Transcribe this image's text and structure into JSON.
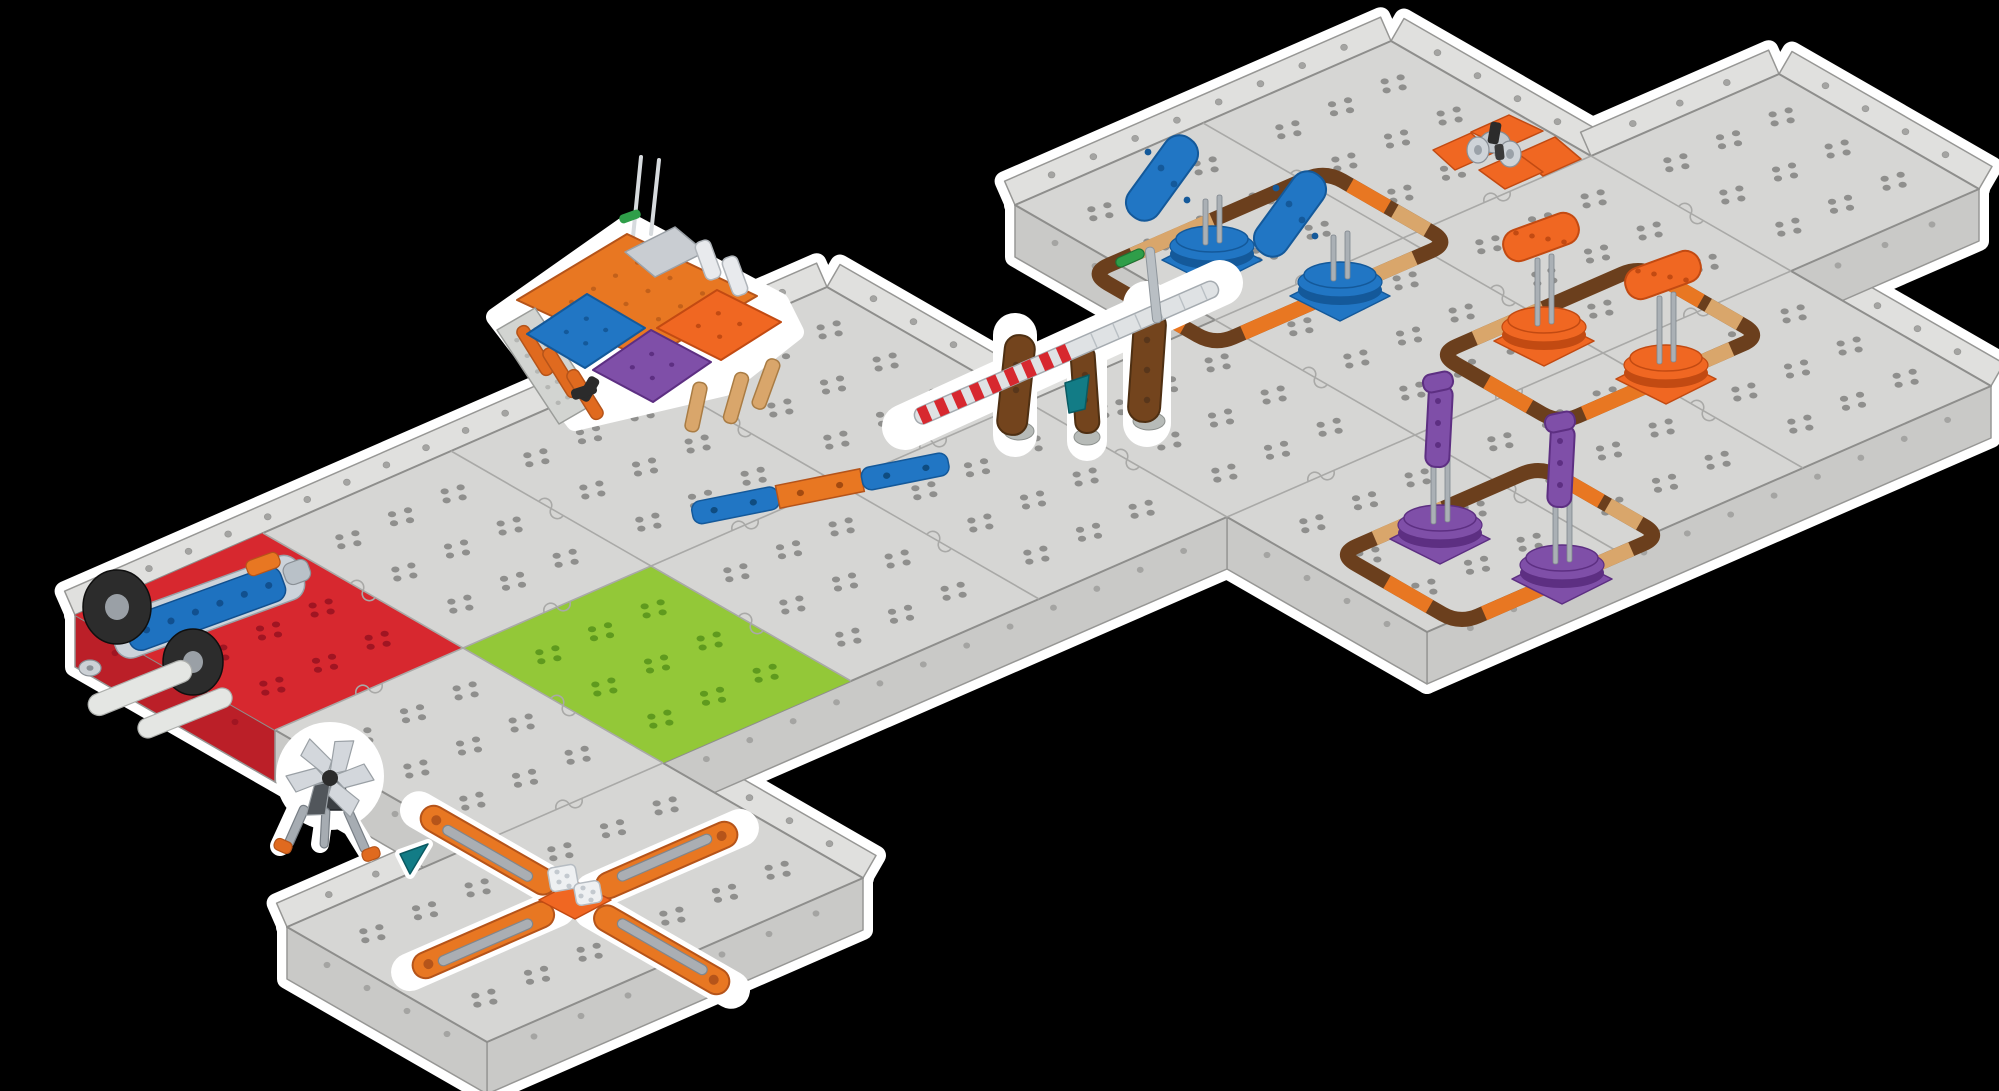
{
  "canvas": {
    "width": 1999,
    "height": 1091,
    "background": "#000000"
  },
  "scene": {
    "description": "Isometric render of a modular robotics field made of gray snap-together tiles with white outline on black background",
    "colors": {
      "halo": "#ffffff",
      "floor": "#d6d6d4",
      "floor_line": "#8e8e8c",
      "wall_face": "#c9c9c7",
      "wall_rim": "#e0e0de",
      "wall_line": "#979795",
      "wall_dot": "#a4a4a2",
      "seam": "#a9a9a7",
      "hole": "#8f8f8d",
      "red_tile": "#d7282f",
      "red_hole": "#a01522",
      "red_wall": "#bb1f28",
      "green_tile": "#93c838",
      "green_hole": "#5f9a1e",
      "ring_brown": "#6b3f1d",
      "ring_tan": "#d9a66b",
      "ring_orange": "#e87722",
      "blue": "#2176c4",
      "blue_dark": "#14599a",
      "orange": "#f06722",
      "orange_dark": "#c24a12",
      "purple": "#7f4fa8",
      "purple_dark": "#5d2f82",
      "teal": "#127c86",
      "gate_brown": "#73441d",
      "gate_brown_dark": "#4e2f12",
      "stripe_red": "#d7282f",
      "pin_green": "#2f9e49",
      "metal": "#aab0b5",
      "metal_dark": "#7e858c",
      "robot_body": "#ccd3da",
      "robot_blue": "#1e72c0",
      "wheel": "#2c2c2c",
      "plate_white": "#e9ebe8",
      "accent_orange": "#e87722"
    },
    "field": {
      "outline": [
        [
          75,
          615
        ],
        [
          827,
          287
        ],
        [
          1027,
          402
        ],
        [
          1215,
          320
        ],
        [
          1015,
          205
        ],
        [
          1391,
          41
        ],
        [
          1591,
          156
        ],
        [
          1779,
          74
        ],
        [
          1979,
          189
        ],
        [
          1791,
          271
        ],
        [
          1991,
          386
        ],
        [
          1427,
          632
        ],
        [
          1227,
          517
        ],
        [
          663,
          763
        ],
        [
          863,
          878
        ],
        [
          487,
          1042
        ],
        [
          287,
          927
        ],
        [
          475,
          845
        ],
        [
          275,
          730
        ]
      ],
      "walls": [
        "rim",
        "rim",
        "rim",
        "face",
        "rim",
        "rim",
        "rim",
        "rim",
        "face",
        "rim",
        "face",
        "face",
        "face",
        "rim",
        "face",
        "face",
        "rim",
        "face",
        "face-red"
      ],
      "wall_drop": 52,
      "rim_width": 26,
      "cells": [
        [
          0,
          0,
          "red"
        ],
        [
          0,
          1
        ],
        [
          0,
          2
        ],
        [
          0,
          3
        ],
        [
          0,
          5
        ],
        [
          0,
          6
        ],
        [
          1,
          0
        ],
        [
          1,
          1,
          "green"
        ],
        [
          1,
          2
        ],
        [
          1,
          3
        ],
        [
          1,
          4
        ],
        [
          1,
          5
        ],
        [
          1,
          6
        ],
        [
          1,
          7
        ],
        [
          2,
          -1
        ],
        [
          2,
          0
        ],
        [
          2,
          4
        ],
        [
          2,
          5
        ],
        [
          2,
          6
        ]
      ],
      "hole_fractions": [
        0.22,
        0.5,
        0.78
      ]
    },
    "elements": {
      "robot": {
        "label": "blue tracked robot on red start platform",
        "center": [
          205,
          615
        ]
      },
      "base_station": {
        "label": "base station with orange roof, blue purple and orange ramp panels and antennas",
        "center": [
          645,
          372
        ]
      },
      "beam": {
        "label": "blue-orange-blue striped beam on floor",
        "center": [
          820,
          489
        ],
        "angle": -11.3
      },
      "gate": {
        "label": "crossing gate with brown pillars, red-white striped bar and teal flag",
        "center": [
          1085,
          345
        ]
      },
      "blue_zone": {
        "label": "blue spinner zone with two flipper turntables inside brown ring track",
        "center": [
          1270,
          258
        ],
        "au": 72,
        "bv": 128,
        "units": [
          [
            -58,
            -6
          ],
          [
            70,
            30
          ]
        ]
      },
      "orange_zone": {
        "label": "orange spinner zone with two post turntables inside brown ring track",
        "center": [
          1600,
          345
        ],
        "au": 70,
        "bv": 110,
        "units": [
          [
            -56,
            -12
          ],
          [
            66,
            26
          ]
        ]
      },
      "purple_zone": {
        "label": "purple spinner zone with two tower turntables inside brown ring track",
        "center": [
          1500,
          545
        ],
        "au": 70,
        "bv": 110,
        "units": [
          [
            -60,
            -14
          ],
          [
            62,
            26
          ]
        ]
      },
      "orange_cross": {
        "label": "small orange cross platform with gray gears",
        "center": [
          1495,
          158
        ]
      },
      "x_spinner": {
        "label": "orange four-arm X spinner with gray rails",
        "center": [
          575,
          900
        ]
      },
      "pinwheel": {
        "label": "gray pinwheel fan on black tripod with orange feet",
        "center": [
          330,
          778
        ]
      },
      "teal_marker": {
        "label": "small teal marker flag",
        "center": [
          400,
          858
        ]
      },
      "ring_segments": [
        [
          0,
          0.18,
          0.52,
          "tan"
        ],
        [
          1,
          0.2,
          0.5,
          "orange"
        ],
        [
          1,
          0.56,
          0.82,
          "tan"
        ],
        [
          2,
          0.15,
          0.45,
          "tan"
        ],
        [
          2,
          0.55,
          0.88,
          "orange"
        ],
        [
          3,
          0.25,
          0.6,
          "orange"
        ]
      ]
    }
  }
}
